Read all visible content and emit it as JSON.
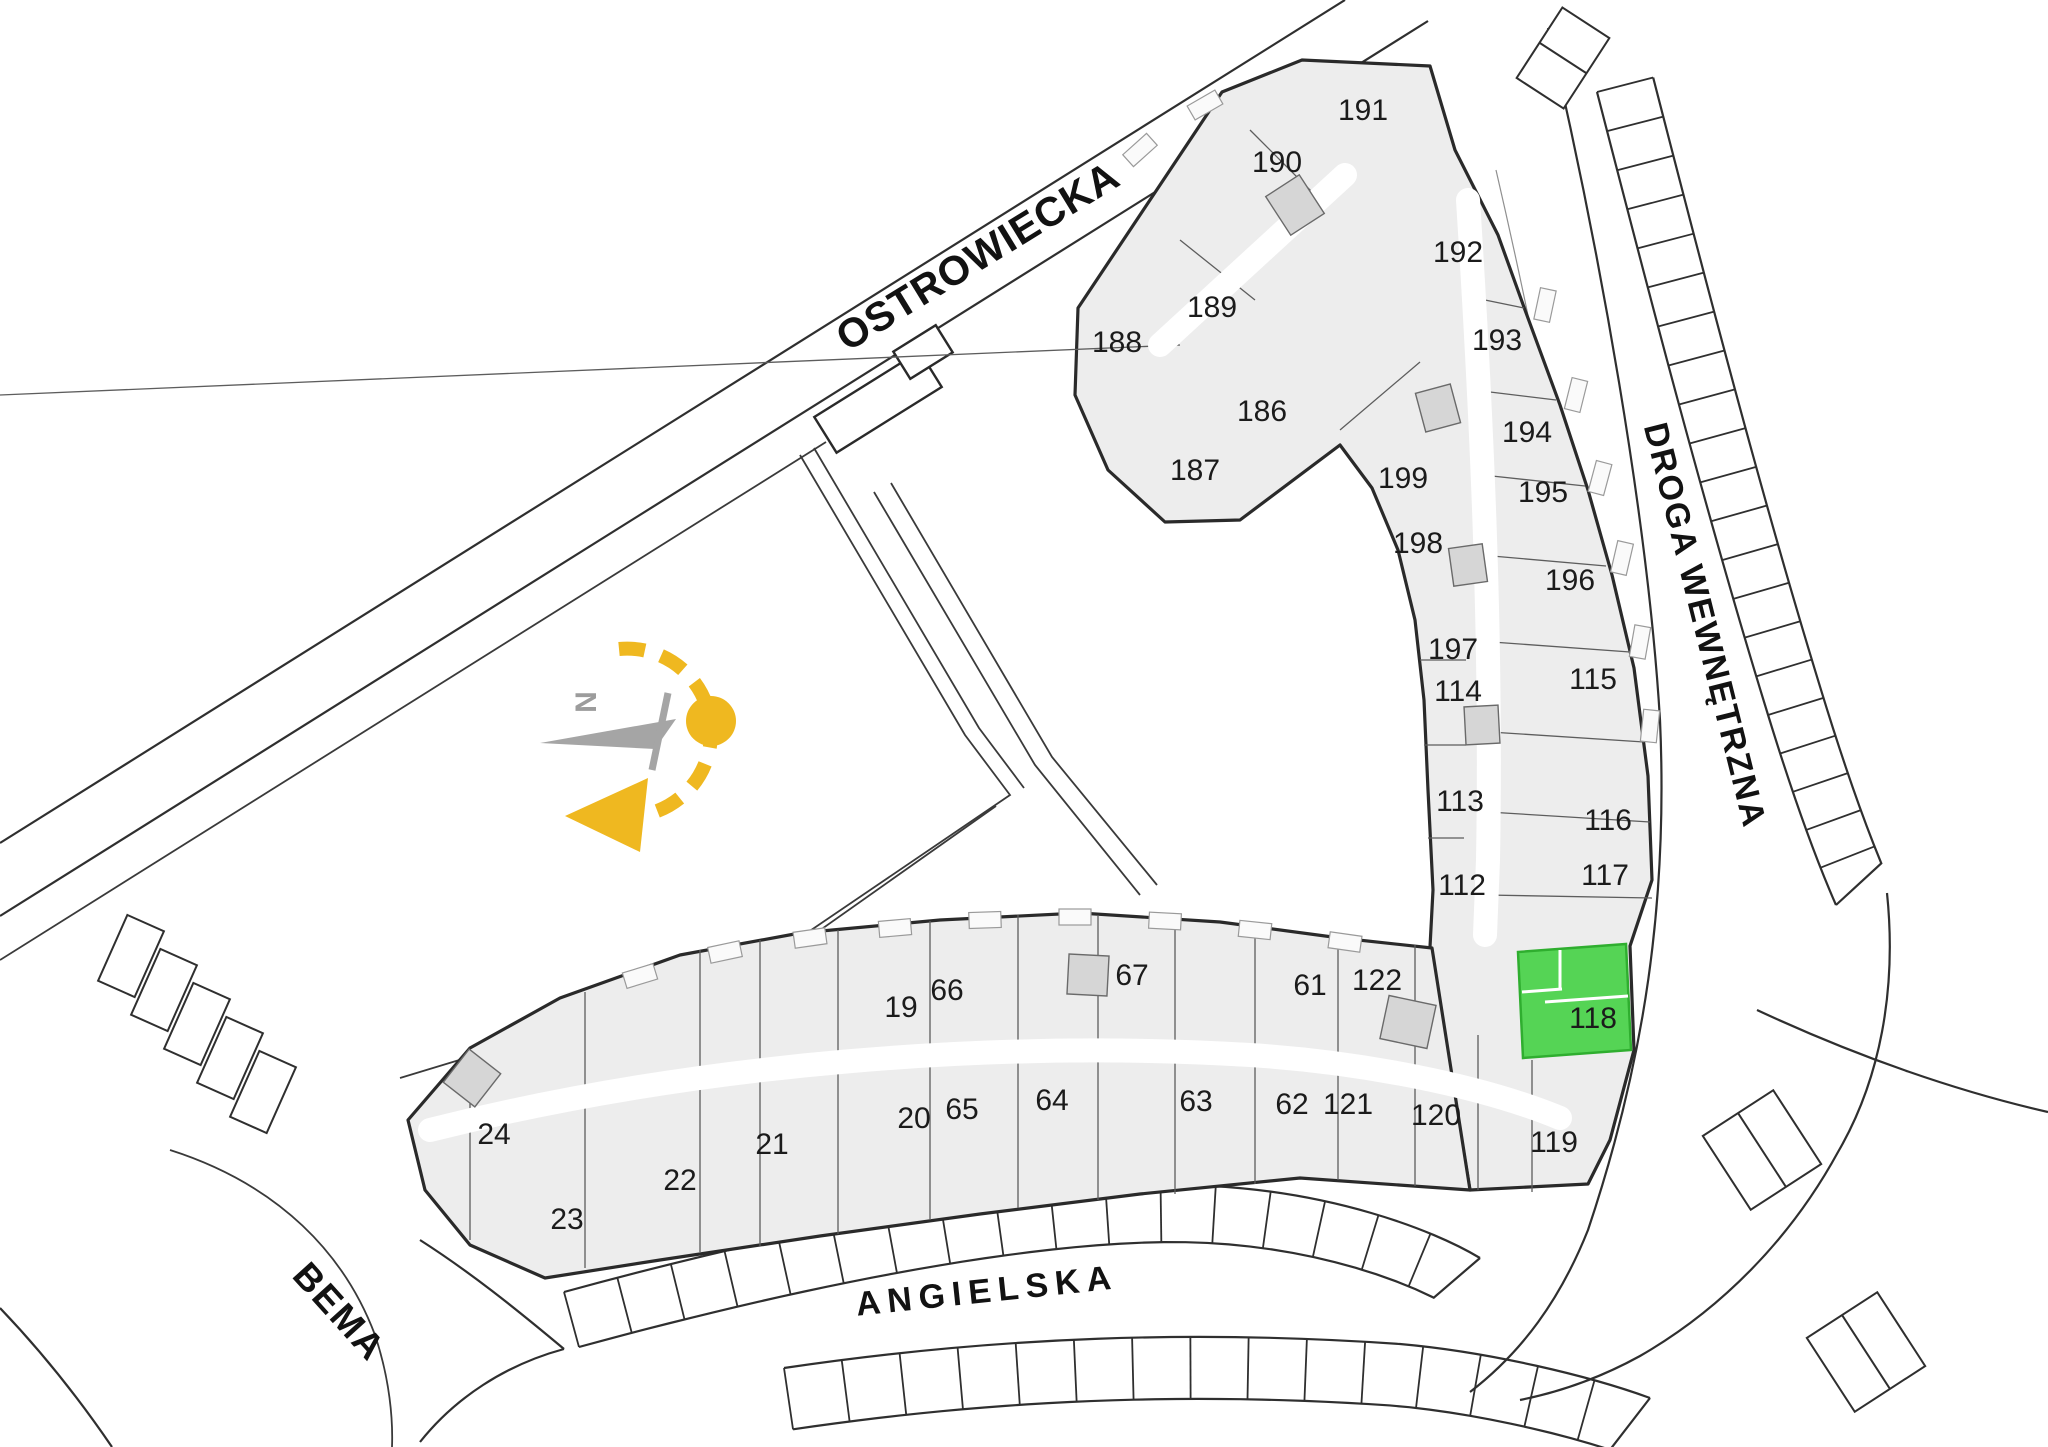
{
  "plan": {
    "title": "Osiedle site plan – floor overview",
    "streets": [
      {
        "key": "ostrowiecka",
        "name": "OSTROWIECKA",
        "x": 985,
        "y": 268,
        "rotation": -31.5,
        "size": 41,
        "spacing": 1
      },
      {
        "key": "droga-wewnetrzna",
        "name": "DROGA WEWNĘTRZNA",
        "x": 1694,
        "y": 628,
        "rotation": 76,
        "size": 34,
        "spacing": 2
      },
      {
        "key": "bema",
        "name": "BEMA",
        "x": 330,
        "y": 1320,
        "rotation": 48,
        "size": 37,
        "spacing": 2
      },
      {
        "key": "angielska",
        "name": "ANGIELSKA",
        "x": 988,
        "y": 1302,
        "rotation": -6,
        "size": 34,
        "spacing": 7
      }
    ],
    "compass": {
      "north_label": "N",
      "accent_color": "#efb820",
      "needle_color": "#a5a5a5"
    },
    "selected_unit": {
      "id": "118",
      "fill": "#55d455",
      "stroke": "#2fae2f",
      "label_color": "#26702a"
    },
    "units": [
      {
        "id": "188",
        "x": 1117,
        "y": 352
      },
      {
        "id": "189",
        "x": 1212,
        "y": 317
      },
      {
        "id": "190",
        "x": 1277,
        "y": 172
      },
      {
        "id": "191",
        "x": 1363,
        "y": 120
      },
      {
        "id": "186",
        "x": 1262,
        "y": 421
      },
      {
        "id": "187",
        "x": 1195,
        "y": 480
      },
      {
        "id": "192",
        "x": 1458,
        "y": 262
      },
      {
        "id": "193",
        "x": 1497,
        "y": 350
      },
      {
        "id": "194",
        "x": 1527,
        "y": 442
      },
      {
        "id": "195",
        "x": 1543,
        "y": 502
      },
      {
        "id": "196",
        "x": 1570,
        "y": 590
      },
      {
        "id": "197",
        "x": 1453,
        "y": 659
      },
      {
        "id": "198",
        "x": 1418,
        "y": 553
      },
      {
        "id": "199",
        "x": 1403,
        "y": 488
      },
      {
        "id": "114",
        "x": 1458,
        "y": 701
      },
      {
        "id": "115",
        "x": 1593,
        "y": 689
      },
      {
        "id": "113",
        "x": 1460,
        "y": 811
      },
      {
        "id": "116",
        "x": 1608,
        "y": 830
      },
      {
        "id": "112",
        "x": 1462,
        "y": 895
      },
      {
        "id": "117",
        "x": 1605,
        "y": 885
      },
      {
        "id": "118",
        "x": 1593,
        "y": 1028,
        "selected": true
      },
      {
        "id": "119",
        "x": 1554,
        "y": 1152
      },
      {
        "id": "120",
        "x": 1436,
        "y": 1125
      },
      {
        "id": "121",
        "x": 1348,
        "y": 1114
      },
      {
        "id": "122",
        "x": 1377,
        "y": 990
      },
      {
        "id": "61",
        "x": 1310,
        "y": 995
      },
      {
        "id": "62",
        "x": 1292,
        "y": 1114
      },
      {
        "id": "63",
        "x": 1196,
        "y": 1111
      },
      {
        "id": "64",
        "x": 1052,
        "y": 1110
      },
      {
        "id": "65",
        "x": 962,
        "y": 1119
      },
      {
        "id": "67",
        "x": 1132,
        "y": 985
      },
      {
        "id": "66",
        "x": 947,
        "y": 1000
      },
      {
        "id": "19",
        "x": 901,
        "y": 1017
      },
      {
        "id": "20",
        "x": 914,
        "y": 1128
      },
      {
        "id": "21",
        "x": 772,
        "y": 1154
      },
      {
        "id": "22",
        "x": 680,
        "y": 1190
      },
      {
        "id": "23",
        "x": 567,
        "y": 1229
      },
      {
        "id": "24",
        "x": 494,
        "y": 1144
      }
    ],
    "colors": {
      "building_fill": "#ededed",
      "wall": "#2a2a2a",
      "road_line": "#2f2f2f",
      "label": "#1b1b1b",
      "background": "#ffffff"
    }
  }
}
